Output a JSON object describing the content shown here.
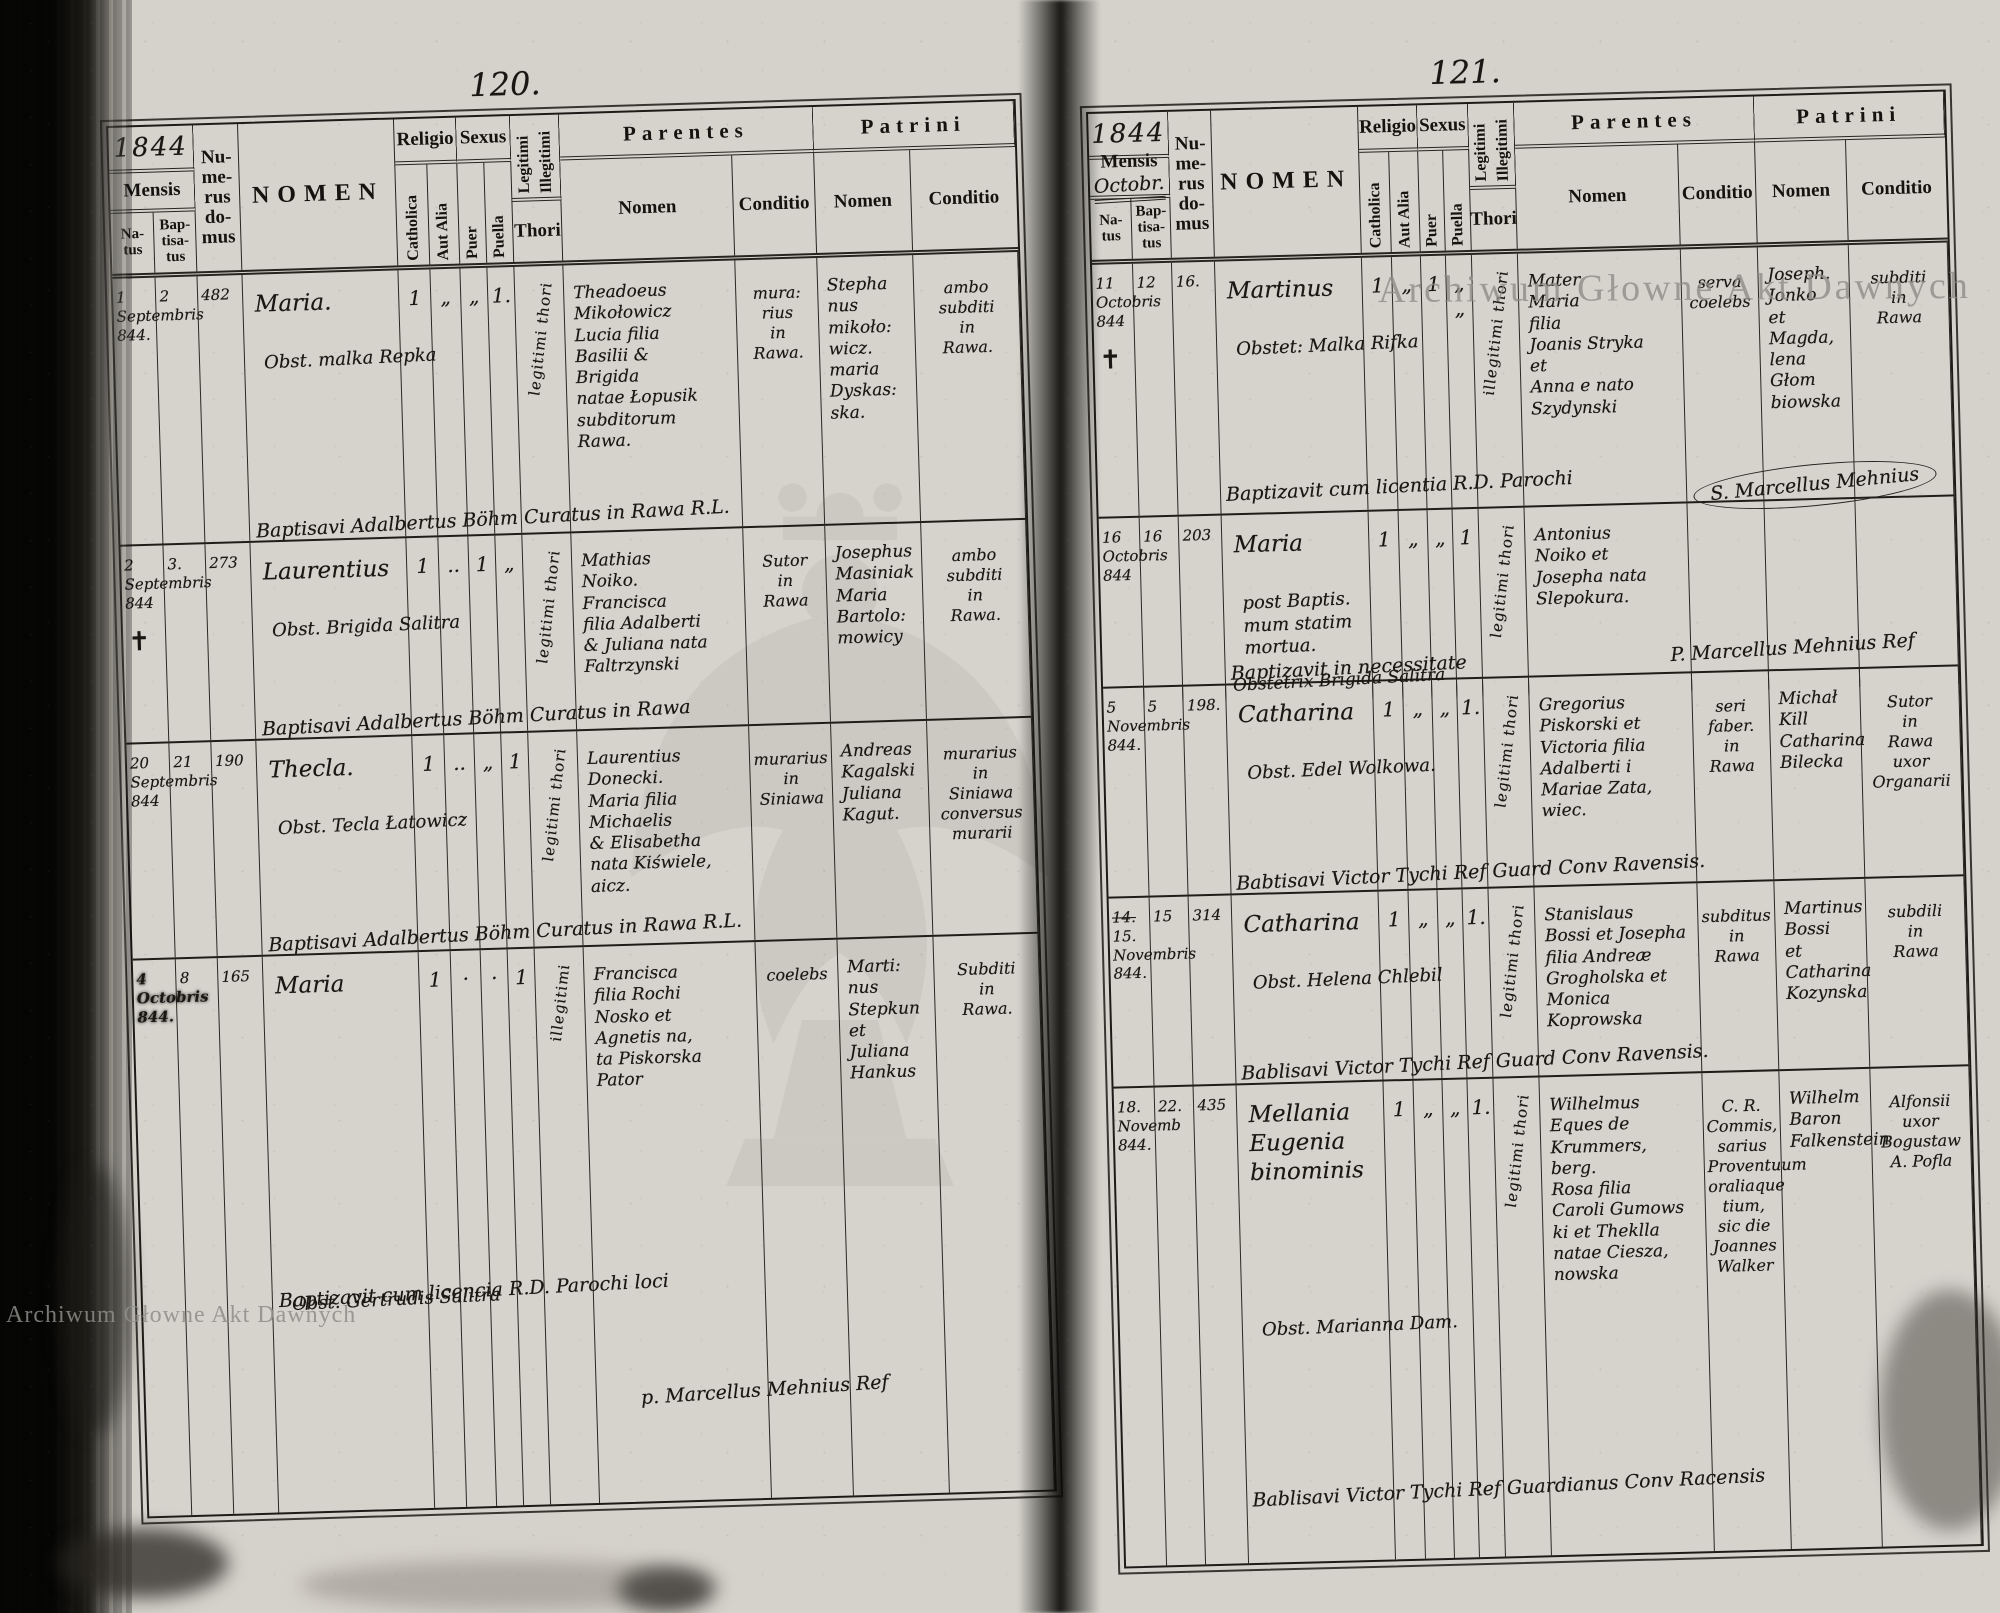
{
  "archive_watermark": "Archiwum Głowne Akt Dawnych",
  "header_labels": {
    "mensis": "Mensis",
    "natus": "Na-\ntus",
    "baptisatus": "Bap-\ntisa-\ntus",
    "numerus_domus": "Nu-\nme-\nrus\ndo-\nmus",
    "nomen": "NOMEN",
    "religio": "Religio",
    "catholica": "Catholica",
    "aut_alia": "Aut Alia",
    "sexus": "Sexus",
    "puer": "Puer",
    "puella": "Puella",
    "legitimi": "Legitimi",
    "illegitimi": "Illegitimi",
    "thori": "Thori",
    "parentes": "Parentes",
    "patrini": "Patrini",
    "nomen_sub": "Nomen",
    "conditio": "Conditio"
  },
  "pages": [
    {
      "page_number": "120.",
      "year": "1844",
      "mensis_note": "",
      "entries": [
        {
          "natus": "1\nSeptembris\n844.",
          "baptisatus": "2",
          "house": "482",
          "name": "Maria.",
          "name_note": "Obst. malka Repka",
          "catholica": "1",
          "aut_alia": "„",
          "puer": "„",
          "puella": "1.",
          "thori": "legitimi thori",
          "parentes_nomen": "Theadoeus\nMikołowicz\nLucia filia\nBasilii &\nBrigida\nnatae Łopusik\nsubditorum\nRawa.",
          "parentes_conditio": "mura:\nrius\nin\nRawa.",
          "patrini_nomen": "Stepha\nnus\nmikoło:\nwicz.\nmaria\nDyskas:\nska.",
          "patrini_conditio": "ambo\nsubditi\nin\nRawa.",
          "footer": "Baptisavi Adalbertus Böhm Curatus in Rawa R.L."
        },
        {
          "natus": "2\nSeptembris\n844",
          "cross": "✝",
          "baptisatus": "3.",
          "house": "273",
          "name": "Laurentius",
          "name_note": "Obst. Brigida Salitra",
          "catholica": "1",
          "aut_alia": "..",
          "puer": "1",
          "puella": "„",
          "thori": "legitimi thori",
          "parentes_nomen": "Mathias\nNoiko.\nFrancisca\nfilia Adalberti\n& Juliana nata\nFaltrzynski",
          "parentes_conditio": "Sutor\nin\nRawa",
          "patrini_nomen": "Josephus\nMasiniak\nMaria\nBartolo:\nmowicy",
          "patrini_conditio": "ambo\nsubditi\nin\nRawa.",
          "footer": "Baptisavi Adalbertus Böhm Curatus in Rawa"
        },
        {
          "natus": "20\nSeptembris\n844",
          "baptisatus": "21",
          "house": "190",
          "name": "Thecla.",
          "name_note": "Obst. Tecla Łatowicz",
          "catholica": "1",
          "aut_alia": "..",
          "puer": "„",
          "puella": "1",
          "thori": "legitimi thori",
          "parentes_nomen": "Laurentius\nDonecki.\nMaria filia\nMichaelis\n& Elisabetha\nnata Kiświele,\naicz.",
          "parentes_conditio": "murarius\nin\nSiniawa",
          "patrini_nomen": "Andreas\nKagalski\nJuliana\nKagut.",
          "patrini_conditio": "murarius\nin\nSiniawa\nconversus\nmurarii",
          "footer": "Baptisavi Adalbertus Böhm Curatus in Rawa R.L."
        },
        {
          "natus": "4\nOctobris\n844.",
          "baptisatus": "8",
          "house": "165",
          "name": "Maria",
          "name_note": "Obst. Gertrudis Salitra",
          "catholica": "1",
          "aut_alia": "·",
          "puer": "·",
          "puella": "1",
          "thori": "illegitimi",
          "parentes_nomen": "Francisca\nfilia Rochi\nNosko et\nAgnetis na,\nta Piskorska\nPator",
          "parentes_conditio": "coelebs",
          "patrini_nomen": "Marti:\nnus\nStepkun\net\nJuliana\nHankus",
          "patrini_conditio": "Subditi\nin\nRawa.",
          "footer": "Baptizavit cum licencia R.D. Parochi loci",
          "footer2": "p. Marcellus Mehnius Ref"
        }
      ]
    },
    {
      "page_number": "121.",
      "year": "1844",
      "mensis_note": "Octobr.",
      "entries": [
        {
          "natus": "11\nOctobris\n844",
          "cross": "✝",
          "baptisatus": "12",
          "house": "16.",
          "name": "Martinus",
          "name_note": "Obstet: Malka Rifka",
          "catholica": "1",
          "aut_alia": "„",
          "puer": "1",
          "puella": "„ „",
          "thori": "illegitimi thori",
          "parentes_nomen": "Mater\nMaria\nfilia\nJoanis Stryka\net\nAnna e nato\nSzydynski",
          "parentes_conditio": "serva\ncoelebs",
          "patrini_nomen": "Joseph.\nJonko\net\nMagda,\nlena\nGłom\nbiowska",
          "patrini_conditio": "subditi\nin\nRawa",
          "footer": "Baptizavit cum licentia R.D. Parochi",
          "footer2": "S. Marcellus Mehnius"
        },
        {
          "natus": "16\nOctobris\n844",
          "baptisatus": "16",
          "house": "203",
          "name": "Maria",
          "name_note": "post Baptis.\nmum statim\nmortua.",
          "name_note2": "Obstetrix Brigida Salitra",
          "catholica": "1",
          "aut_alia": "„",
          "puer": "„",
          "puella": "1",
          "thori": "legitimi thori",
          "parentes_nomen": "Antonius\nNoiko et\nJosepha nata\nSlepokura.",
          "footer": "Baptizavit in necessitate",
          "footer2": "P. Marcellus Mehnius Ref"
        },
        {
          "natus": "5\nNovembris\n844.",
          "baptisatus": "5",
          "house": "198.",
          "name": "Catharina",
          "name_note": "Obst. Edel Wolkowa.",
          "catholica": "1",
          "aut_alia": "„",
          "puer": "„",
          "puella": "1.",
          "thori": "legitimi thori",
          "parentes_nomen": "Gregorius\nPiskorski et\nVictoria filia\nAdalberti i\nMariae Zata,\nwiec.",
          "parentes_conditio": "seri\nfaber.\nin\nRawa",
          "patrini_nomen": "Michał\nKill\nCatharina\nBilecka",
          "patrini_conditio": "Sutor\nin\nRawa\nuxor\nOrganarii",
          "footer": "Babtisavi Victor Tychi Ref Guard Conv Ravensis."
        },
        {
          "natus_pre": "14.",
          "natus": "15.\nNovembris\n844.",
          "baptisatus": "15",
          "house": "314",
          "name": "Catharina",
          "name_note": "Obst. Helena Chlebil",
          "catholica": "1",
          "aut_alia": "„",
          "puer": "„",
          "puella": "1.",
          "thori": "legitimi thori",
          "parentes_nomen": "Stanislaus\nBossi et Josepha\nfilia Andreæ\nGrogholska et\nMonica Koprowska",
          "parentes_conditio": "subditus\nin\nRawa",
          "patrini_nomen": "Martinus\nBossi\net\nCatharina\nKozynska",
          "patrini_conditio": "subdili\nin\nRawa",
          "footer": "Bablisavi Victor Tychi Ref Guard Conv Ravensis."
        },
        {
          "natus": "18.\nNovemb\n844.",
          "baptisatus": "22.",
          "house": "435",
          "name": "Mellania\nEugenia\nbinominis",
          "name_note": "Obst. Marianna Dam.",
          "catholica": "1",
          "aut_alia": "„",
          "puer": "„",
          "puella": "1.",
          "thori": "legitimi thori",
          "parentes_nomen": "Wilhelmus\nEques de\nKrummers,\nberg.\nRosa filia\nCaroli Gumows\nki et Theklla\nnatae Ciesza,\nnowska",
          "parentes_conditio": "C. R.\nCommis,\nsarius\nProventuum\noraliaque\ntium,\nsic die\nJoannes\nWalker",
          "patrini_nomen": "Wilhelm Baron\nFalkenstein",
          "patrini_conditio": "Alfonsii uxor\nBogustaw\nA. Pofla",
          "footer": "Bablisavi Victor Tychi Ref Guardianus Conv Racensis"
        }
      ]
    }
  ]
}
